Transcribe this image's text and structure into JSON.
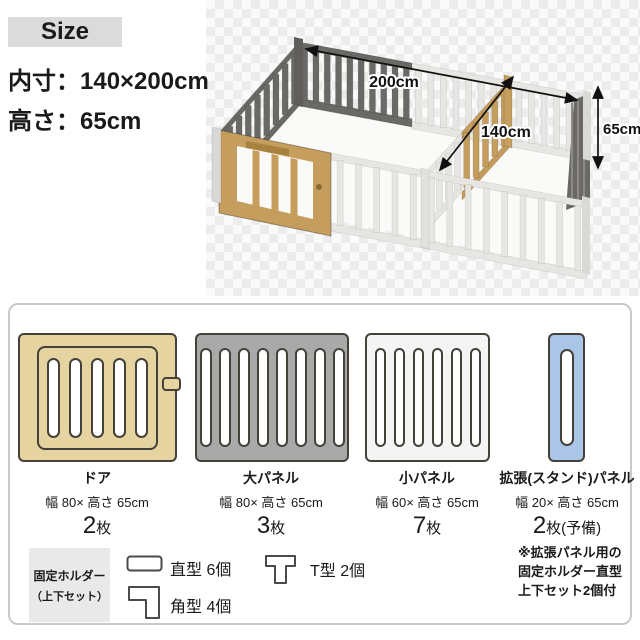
{
  "size_section": {
    "badge": "Size",
    "line1": "内寸：140×200cm",
    "line2": "高さ：65cm"
  },
  "render_labels": {
    "width": "200cm",
    "depth": "140cm",
    "height": "65cm"
  },
  "parts": {
    "panels": [
      {
        "name": "ドア",
        "size": "幅 80× 高さ 65cm",
        "count": "2",
        "unit": "枚"
      },
      {
        "name": "大パネル",
        "size": "幅 80× 高さ 65cm",
        "count": "3",
        "unit": "枚"
      },
      {
        "name": "小パネル",
        "size": "幅 60× 高さ 65cm",
        "count": "7",
        "unit": "枚"
      },
      {
        "name": "拡張(スタンド)パネル",
        "size": "幅 20× 高さ 65cm",
        "count": "2",
        "unit": "枚(予備)"
      }
    ],
    "holder": {
      "line1": "固定ホルダー",
      "line2": "（上下セット）"
    },
    "holder_counts": {
      "straight": "直型 6個",
      "corner": "角型 4個",
      "t": "T型 2個"
    },
    "note": [
      "※拡張パネル用の",
      "固定ホルダー直型",
      "上下セット2個付"
    ]
  },
  "colors": {
    "text": "#1A1A1A",
    "badge_bg": "#DBDBDB",
    "box_border": "#C9C9C9",
    "holder_bg": "#E9E9E9",
    "door_diagram": "#E5D3A0",
    "large_panel": "#A9A9A9",
    "small_panel": "#F4F4F4",
    "expand_panel": "#ABC5E6",
    "fence_dark": "#6B6965",
    "fence_white": "#E7E6E3",
    "fence_tan": "#C59D5C",
    "floor3d": "#FAFAF9"
  }
}
